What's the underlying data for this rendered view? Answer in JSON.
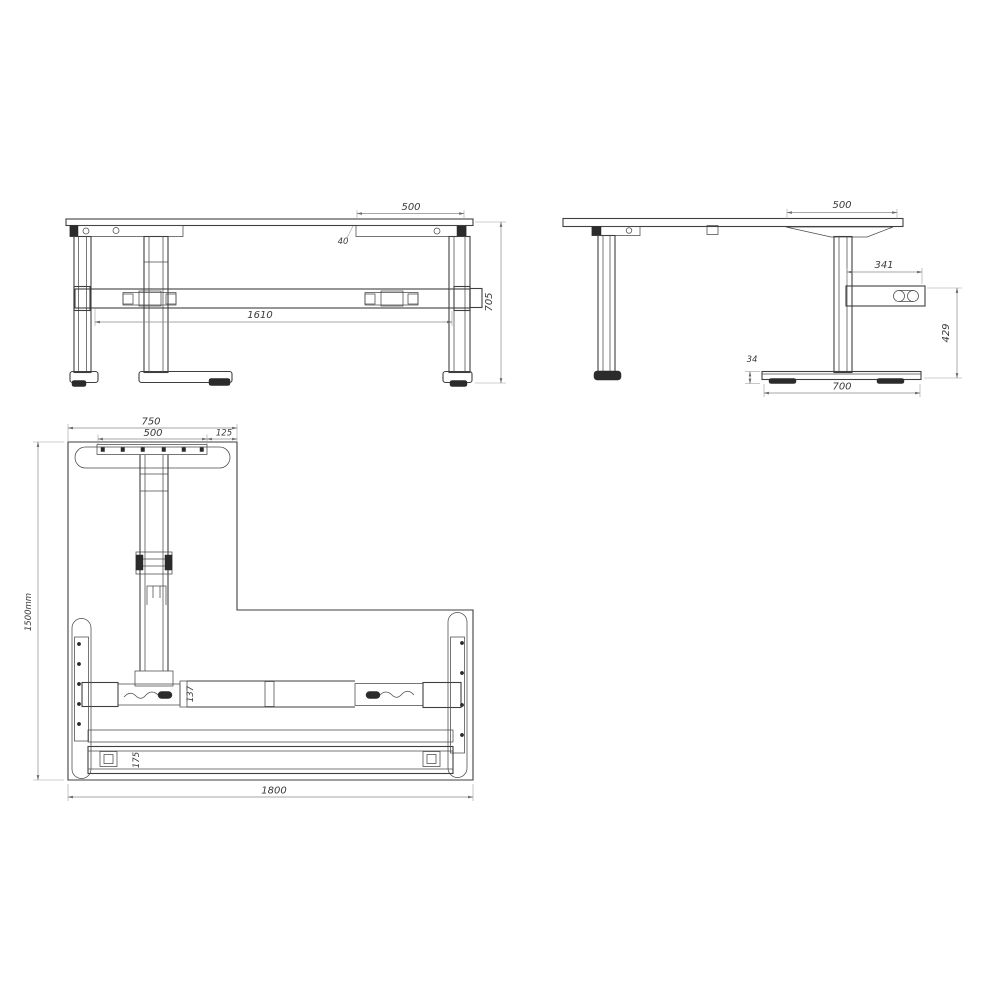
{
  "colors": {
    "background": "#ffffff",
    "line": "#3f3f3f",
    "dim_line": "#8a8a8a",
    "text": "#3a3a3a",
    "fill_dark": "#2b2b2b"
  },
  "front_view": {
    "name": "front elevation of desk frame",
    "dims": {
      "bracket_width": "500",
      "bracket_drop": "40",
      "frame_width": "1610",
      "overall_height": "705"
    }
  },
  "side_view": {
    "name": "side elevation of desk frame",
    "dims": {
      "bracket_depth": "500",
      "control_arm_length": "341",
      "column_height": "429",
      "foot_height": "34",
      "foot_depth": "700"
    }
  },
  "plan_view": {
    "name": "underside plan of L-shaped desk top",
    "dims": {
      "return_width": "750",
      "bracket_width": "500",
      "edge_offset": "125",
      "overall_depth": "1500mm",
      "crossbar_depth": "137",
      "rear_rail_depth": "175",
      "overall_width": "1800"
    }
  }
}
